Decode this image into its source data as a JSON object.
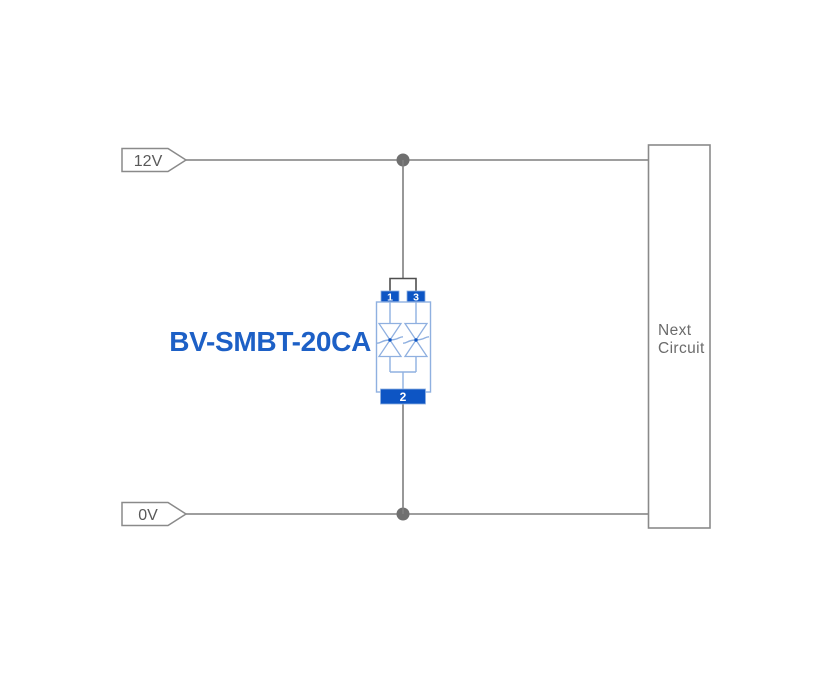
{
  "diagram_title": "TVS diode application circuit",
  "component": {
    "name": "BV-SMBT-20CA",
    "pins": {
      "pin1": "1",
      "pin2": "2",
      "pin3": "3"
    }
  },
  "rails": {
    "top": "12V",
    "bottom": "0V"
  },
  "next_circuit": {
    "line1": "Next",
    "line2": "Circuit"
  },
  "icons": [
    "junction-dot-icon",
    "bidirectional-tvs-diode-icon",
    "net-label-tag-icon"
  ],
  "colors": {
    "background": "#ffffff",
    "wire_gray": "#7f7f7f",
    "junction_gray": "#6f6f6f",
    "outline_gray": "#8a8a8a",
    "tag_text_gray": "#595959",
    "box_text_gray": "#6b6b6b",
    "connector_dark": "#4f4f4f",
    "pad_blue": "#0d55c4",
    "symbol_light_blue": "#8fb0e0",
    "label_blue": "#1d60c6"
  }
}
